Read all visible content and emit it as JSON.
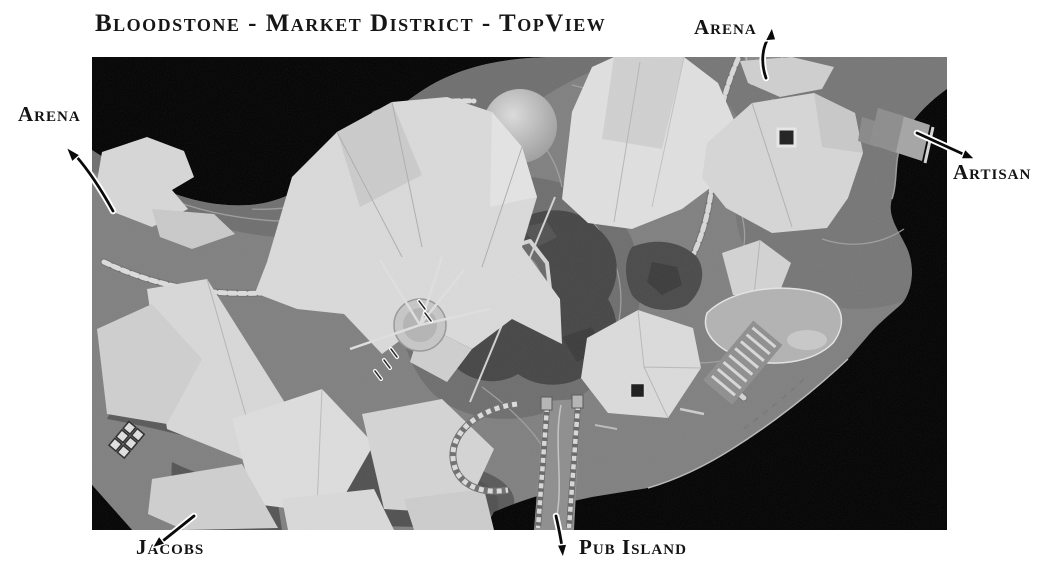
{
  "title": "Bloodstone - Market District - TopView",
  "labels": [
    {
      "id": "arena-top",
      "text": "Arena"
    },
    {
      "id": "arena-left",
      "text": "Arena"
    },
    {
      "id": "artisan",
      "text": "Artisan"
    },
    {
      "id": "jacobs",
      "text": "Jacobs"
    },
    {
      "id": "pub-island",
      "text": "Pub Island"
    }
  ],
  "map": {
    "background": "#000000"
  },
  "colors": {
    "page_bg": "#ffffff",
    "text": "#141414",
    "arrow": "#0a0a0a",
    "arrow_outline": "#ffffff"
  }
}
